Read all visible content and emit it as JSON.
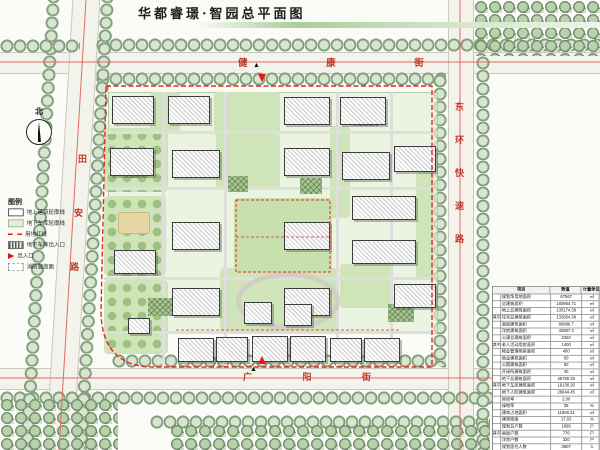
{
  "title": "华都睿璟·智园总平面图",
  "north_label": "北",
  "streets": {
    "top": "健 康 街",
    "bottom": "广 阳 街",
    "left": [
      "田",
      "安",
      "路"
    ],
    "right": "东环快速路"
  },
  "legend": {
    "title": "图例",
    "items": [
      {
        "label": "地上建筑轮廓线",
        "symbol": "building-outline"
      },
      {
        "label": "地下车库轮廓线",
        "symbol": "garage-outline"
      },
      {
        "label": "用地红线",
        "symbol": "red-line"
      },
      {
        "label": "地下车库出入口",
        "symbol": "garage-entrance"
      },
      {
        "label": "出入口",
        "symbol": "entrance-arrow"
      },
      {
        "label": "消防登高面",
        "symbol": "fire-access"
      }
    ]
  },
  "table": {
    "headers": [
      "项目",
      "数值",
      "计量单位"
    ],
    "rows": [
      {
        "group": "",
        "name": "规划净用地面积",
        "value": "67567",
        "unit": "㎡"
      },
      {
        "group": "",
        "name": "总建筑面积",
        "value": "180954.71",
        "unit": "㎡"
      },
      {
        "group": "",
        "name": "地上总建筑面积",
        "value": "135174.38",
        "unit": "㎡"
      },
      {
        "group": "其中",
        "name": "住宅总建筑面积",
        "value": "132854.38",
        "unit": "㎡"
      },
      {
        "group": "其中",
        "name": "高层建筑面积",
        "value": "89986.7",
        "unit": "㎡"
      },
      {
        "group": "其中",
        "name": "洋房建筑面积",
        "value": "42867.3",
        "unit": "㎡"
      },
      {
        "group": "",
        "name": "公建总建筑面积",
        "value": "2320",
        "unit": "㎡"
      },
      {
        "group": "其中",
        "name": "老人活动用房面积",
        "value": "1400",
        "unit": "㎡"
      },
      {
        "group": "其中",
        "name": "物业管理用房面积",
        "value": "400",
        "unit": "㎡"
      },
      {
        "group": "其中",
        "name": "商业建筑面积",
        "value": "50",
        "unit": "㎡"
      },
      {
        "group": "其中",
        "name": "公厕建筑面积",
        "value": "50",
        "unit": "㎡"
      },
      {
        "group": "其中",
        "name": "开闭所建筑面积",
        "value": "40",
        "unit": "㎡"
      },
      {
        "group": "",
        "name": "地下总建筑面积",
        "value": "45780.33",
        "unit": "㎡"
      },
      {
        "group": "其中",
        "name": "地下车库建筑面积",
        "value": "19136.26",
        "unit": "㎡"
      },
      {
        "group": "其中",
        "name": "地下人防建筑面积",
        "value": "26644.45",
        "unit": "㎡"
      },
      {
        "group": "",
        "name": "容积率",
        "value": "2.00",
        "unit": ""
      },
      {
        "group": "",
        "name": "绿地率",
        "value": "35",
        "unit": "%"
      },
      {
        "group": "",
        "name": "建筑占地面积",
        "value": "11508.21",
        "unit": "㎡"
      },
      {
        "group": "",
        "name": "建筑密度",
        "value": "17.03",
        "unit": "%"
      },
      {
        "group": "",
        "name": "规划总户数",
        "value": "1096",
        "unit": "户"
      },
      {
        "group": "其中",
        "name": "高层户数",
        "value": "776",
        "unit": "户"
      },
      {
        "group": "其中",
        "name": "洋房户数",
        "value": "320",
        "unit": "户"
      },
      {
        "group": "",
        "name": "规划居住人数",
        "value": "3507",
        "unit": "人"
      },
      {
        "group": "",
        "name": "机动车停车位",
        "value": "1352",
        "unit": "个"
      },
      {
        "group": "",
        "name": "非机动车停车位",
        "value": "2199",
        "unit": "辆"
      }
    ]
  }
}
